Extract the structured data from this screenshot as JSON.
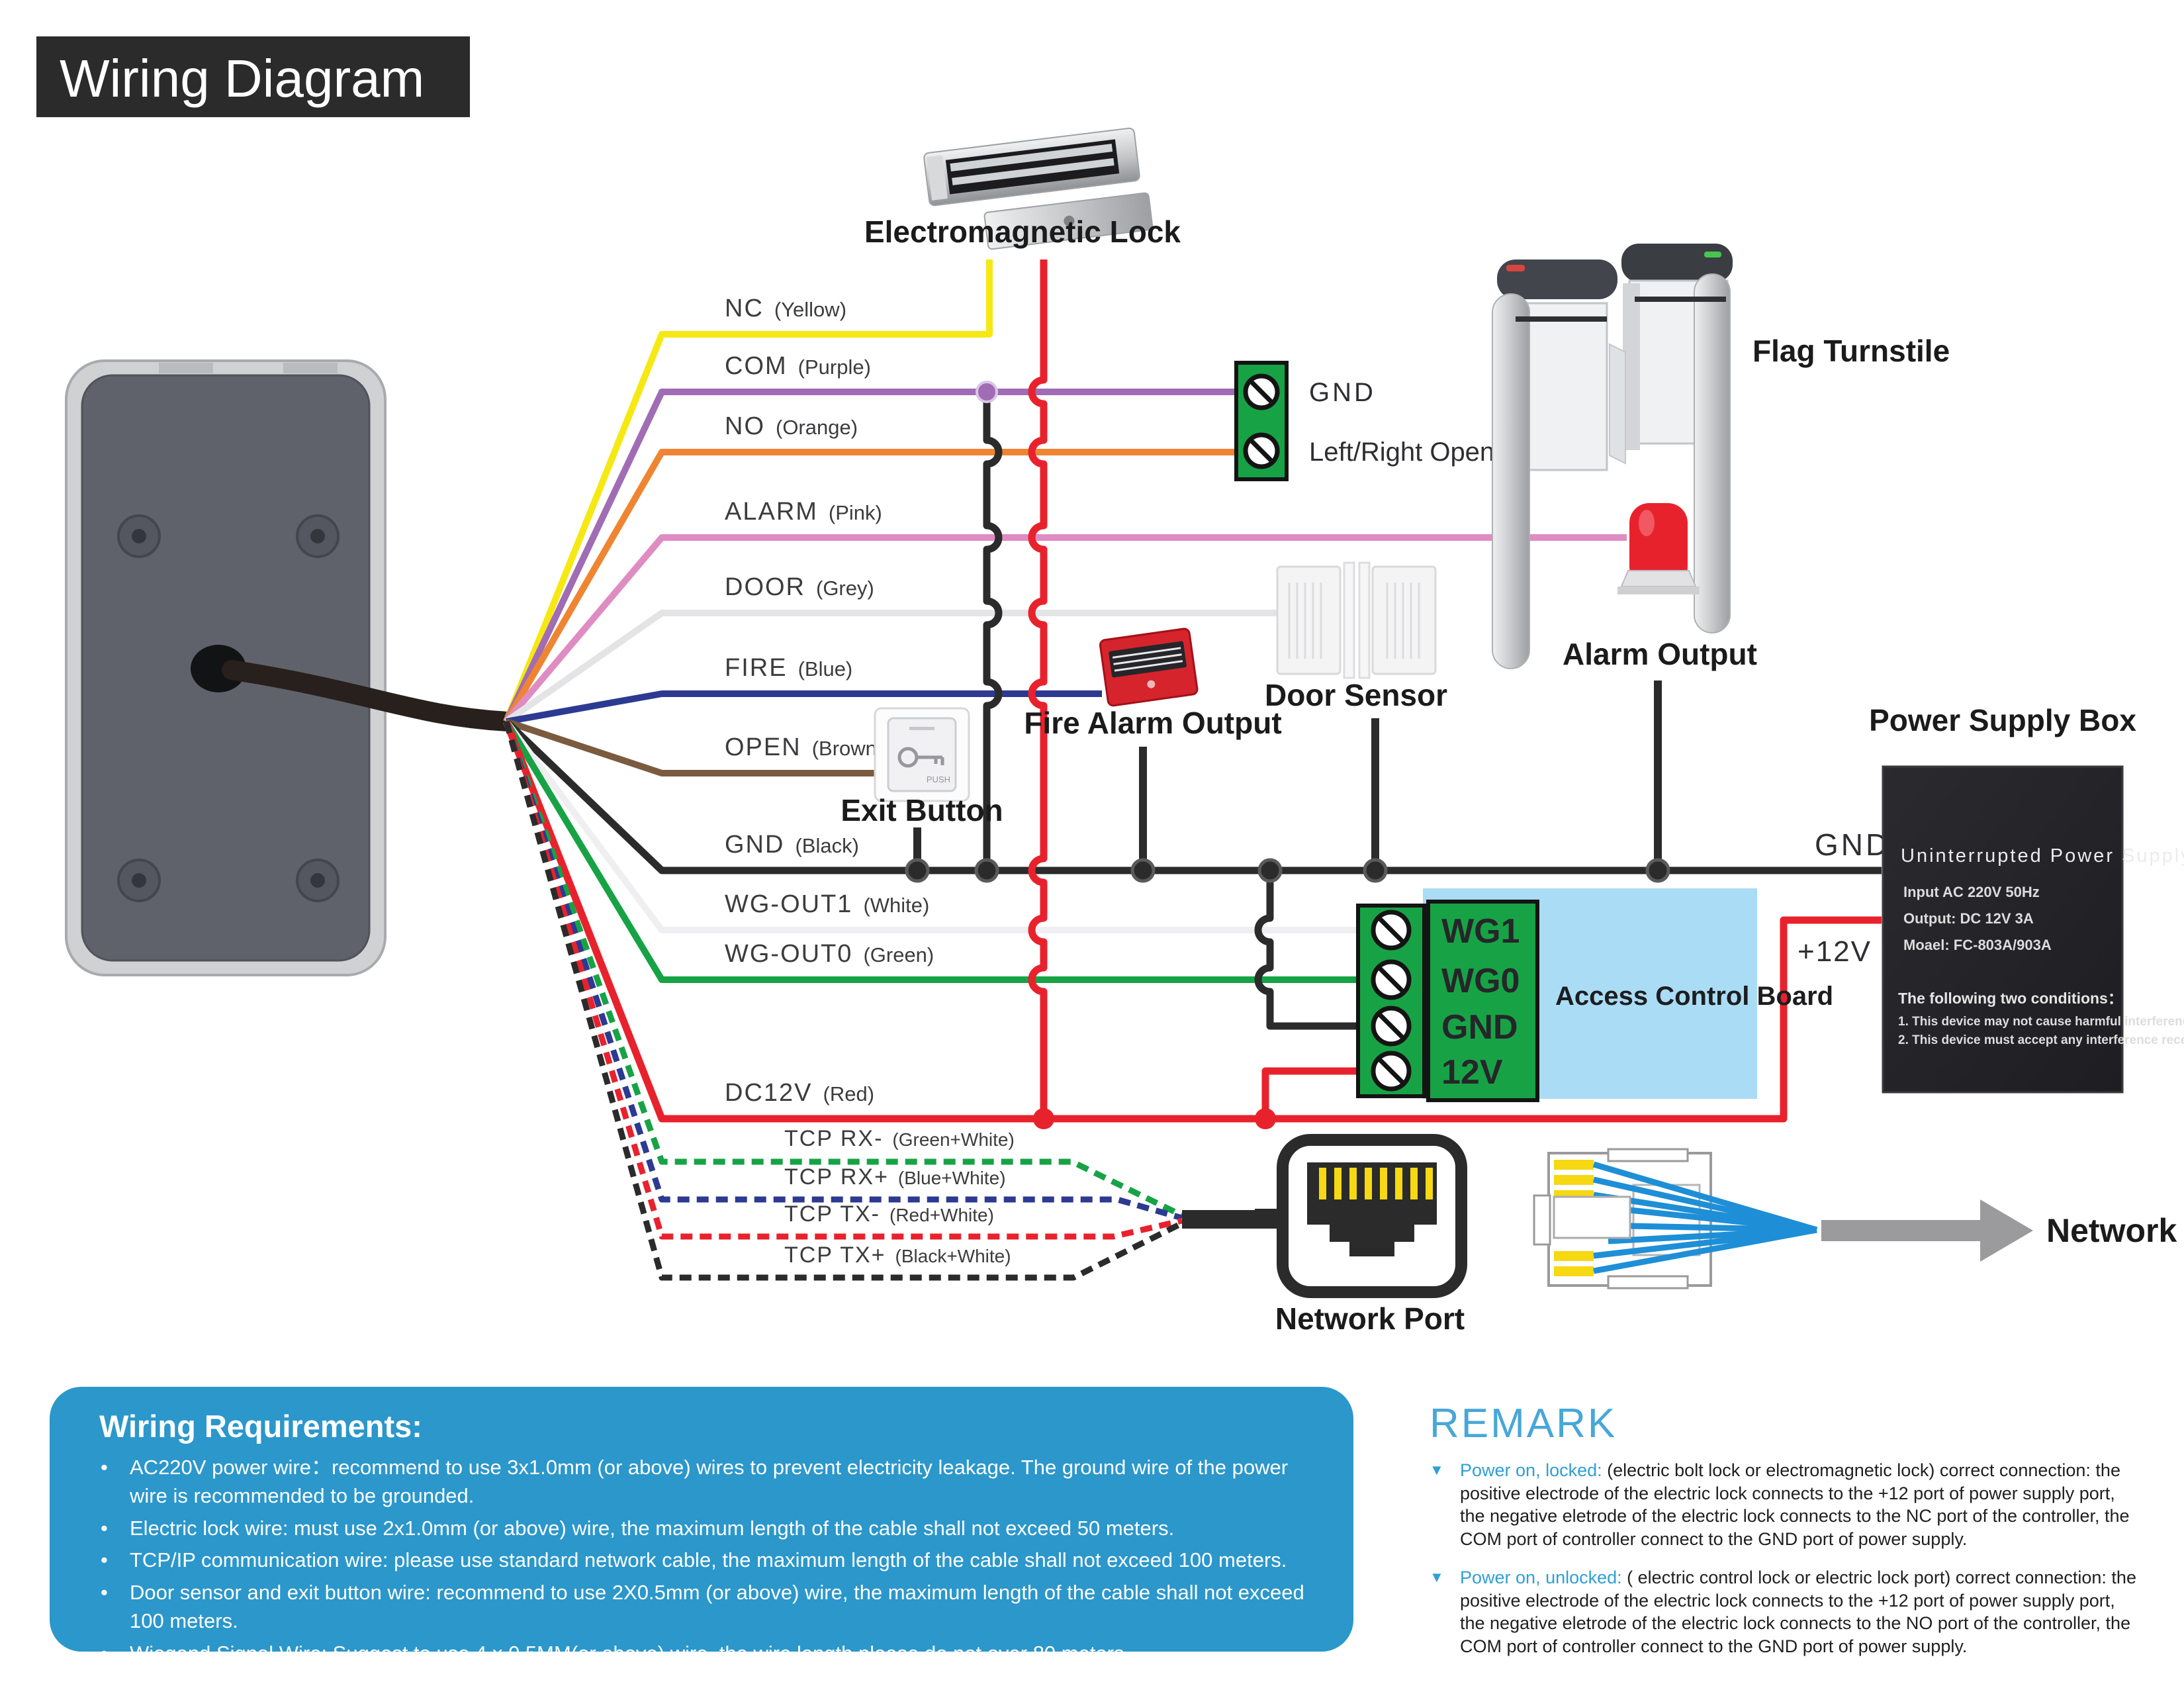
{
  "title": "Wiring Diagram",
  "wires": [
    {
      "name": "NC",
      "color_note": "(Yellow)",
      "hex": "#f6e813"
    },
    {
      "name": "COM",
      "color_note": "(Purple)",
      "hex": "#a06cb4"
    },
    {
      "name": "NO",
      "color_note": "(Orange)",
      "hex": "#ef8532"
    },
    {
      "name": "ALARM",
      "color_note": "(Pink)",
      "hex": "#df8cc3"
    },
    {
      "name": "DOOR",
      "color_note": "(Grey)",
      "hex": "#e4e4e6"
    },
    {
      "name": "FIRE",
      "color_note": "(Blue)",
      "hex": "#2c3a92"
    },
    {
      "name": "OPEN",
      "color_note": "(Brown)",
      "hex": "#7b5b3f"
    },
    {
      "name": "GND",
      "color_note": "(Black)",
      "hex": "#2b2b2b"
    },
    {
      "name": "WG-OUT1",
      "color_note": "(White)",
      "hex": "#efeff1"
    },
    {
      "name": "WG-OUT0",
      "color_note": "(Green)",
      "hex": "#17a345"
    },
    {
      "name": "DC12V",
      "color_note": "(Red)",
      "hex": "#e8222d"
    },
    {
      "name": "TCP RX-",
      "color_note": "(Green+White)",
      "hex": "#17a345"
    },
    {
      "name": "TCP RX+",
      "color_note": "(Blue+White)",
      "hex": "#2c3a92"
    },
    {
      "name": "TCP TX-",
      "color_note": "(Red+White)",
      "hex": "#e8222d"
    },
    {
      "name": "TCP TX+",
      "color_note": "(Black+White)",
      "hex": "#2b2b2b"
    }
  ],
  "labels": {
    "em_lock": "Electromagnetic Lock",
    "flag_turnstile": "Flag Turnstile",
    "terminal_gnd": "GND",
    "terminal_open": "Left/Right Open",
    "alarm_output": "Alarm Output",
    "door_sensor": "Door Sensor",
    "fire_alarm": "Fire Alarm Output",
    "exit_button": "Exit Button",
    "push": "PUSH",
    "network_port": "Network Port",
    "network": "Network",
    "power_supply_box": "Power Supply Box",
    "gnd_right": "GND",
    "plus12v": "+12V",
    "access_control_board": "Access Control Board"
  },
  "board_terminals": [
    "WG1",
    "WG0",
    "GND",
    "12V"
  ],
  "power_supply": {
    "title": "Uninterrupted Power Supply",
    "input": "Input  AC 220V 50Hz",
    "output": "Output: DC 12V 3A",
    "model": "Moael: FC-803A/903A",
    "conditions_title": "The following two conditions：",
    "condition1": "1. This device may not cause harmful interference",
    "condition2": "2. This device must accept any interference received"
  },
  "requirements": {
    "title": "Wiring Requirements:",
    "items": [
      "AC220V power wire：recommend to use 3x1.0mm (or above) wires to prevent electricity leakage. The ground wire of the power wire is recommended to be grounded.",
      "Electric lock wire: must use 2x1.0mm (or above) wire, the maximum length of the cable shall not exceed 50 meters.",
      "TCP/IP communication wire: please use standard network cable, the maximum length of the cable shall not exceed 100 meters.",
      "Door sensor and exit button wire: recommend to use 2X0.5mm (or above) wire, the maximum length of the cable shall not exceed 100 meters.",
      "Wiegand Signal Wire: Suggest to use 4 x 0.5MM(or above) wire, the wire length please do not over 80 meters."
    ]
  },
  "remark": {
    "title": "REMARK",
    "items": [
      {
        "lead": "Power on, locked:",
        "body": "(electric bolt lock or electromagnetic lock) correct connection: the positive electrode of the electric lock connects to the +12 port of power supply port, the negative eletrode of the electric lock connects to the NC port of the controller, the COM port of controller connect to the GND port of power supply."
      },
      {
        "lead": "Power on, unlocked:",
        "body": "( electric control lock or electric lock port) correct connection: the positive electrode of the electric lock connects to the +12 port of power supply port, the negative eletrode of the electric lock connects to the NO port of the controller, the COM port of controller connect to the GND port of power supply."
      }
    ]
  }
}
